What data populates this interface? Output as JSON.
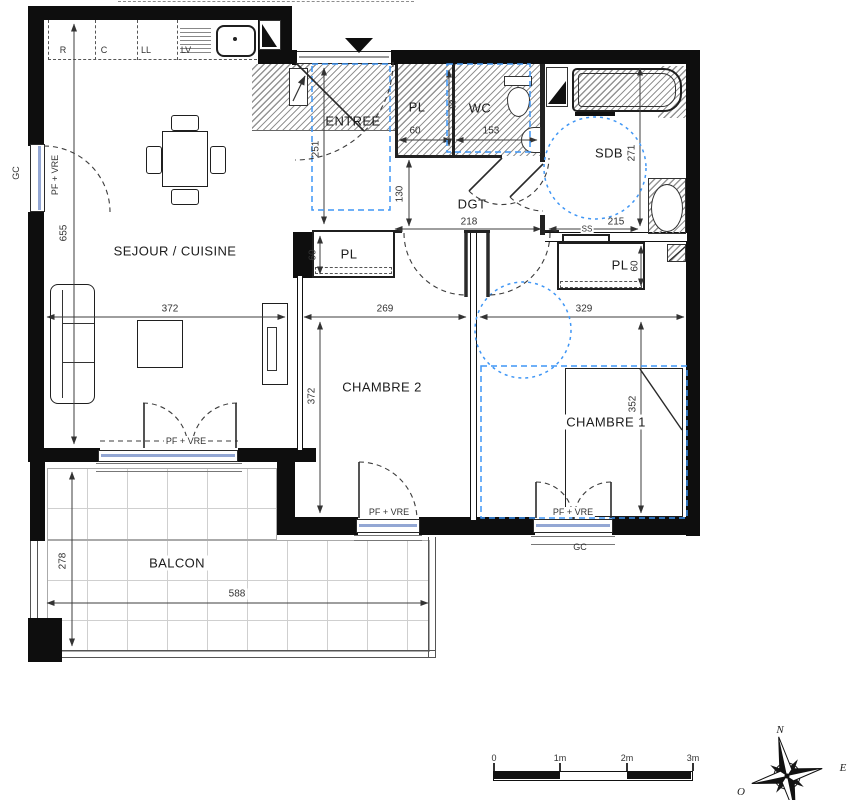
{
  "meta": {
    "kind": "apartment floor plan"
  },
  "colors": {
    "wall": "#0e0e0e",
    "accessibility_blue": "#3f96f5",
    "dimension_line": "#3c3c3c",
    "hatch_line": "#949494",
    "glazing": "#93a7d4"
  },
  "rooms": {
    "sejour_cuisine": {
      "label": "SEJOUR / CUISINE"
    },
    "entree": {
      "label": "ENTREE"
    },
    "pl_entree": {
      "label": "PL"
    },
    "wc": {
      "label": "WC"
    },
    "sdb": {
      "label": "SDB"
    },
    "dgt": {
      "label": "DGT"
    },
    "pl_chambre2": {
      "label": "PL"
    },
    "pl_chambre1": {
      "label": "PL"
    },
    "chambre2": {
      "label": "CHAMBRE 2"
    },
    "chambre1": {
      "label": "CHAMBRE 1"
    },
    "balcon": {
      "label": "BALCON"
    }
  },
  "dimensions_cm": {
    "sejour_height": "655",
    "sejour_width": "372",
    "entree_height": "251",
    "pl_entree_width": "60",
    "wc_width": "153",
    "wc_clearance": "90",
    "dgt_height": "130",
    "dgt_width": "218",
    "sdb_width": "215",
    "sdb_height": "271",
    "pl_chambre2_depth": "60",
    "pl_chambre1_depth": "60",
    "chambre2_width": "269",
    "chambre2_height": "372",
    "chambre1_width": "329",
    "chambre1_height": "352",
    "balcon_height": "278",
    "balcon_width": "588"
  },
  "annotations": {
    "window_label": "PF + VRE",
    "gc": "GC",
    "towel_rail": "SS"
  },
  "kitchen_appliances": [
    "R",
    "C",
    "LL",
    "LV"
  ],
  "scale_bar": {
    "ticks": [
      "0",
      "1m",
      "2m",
      "3m"
    ]
  },
  "compass": {
    "north": "N",
    "east": "E",
    "west": "O"
  }
}
